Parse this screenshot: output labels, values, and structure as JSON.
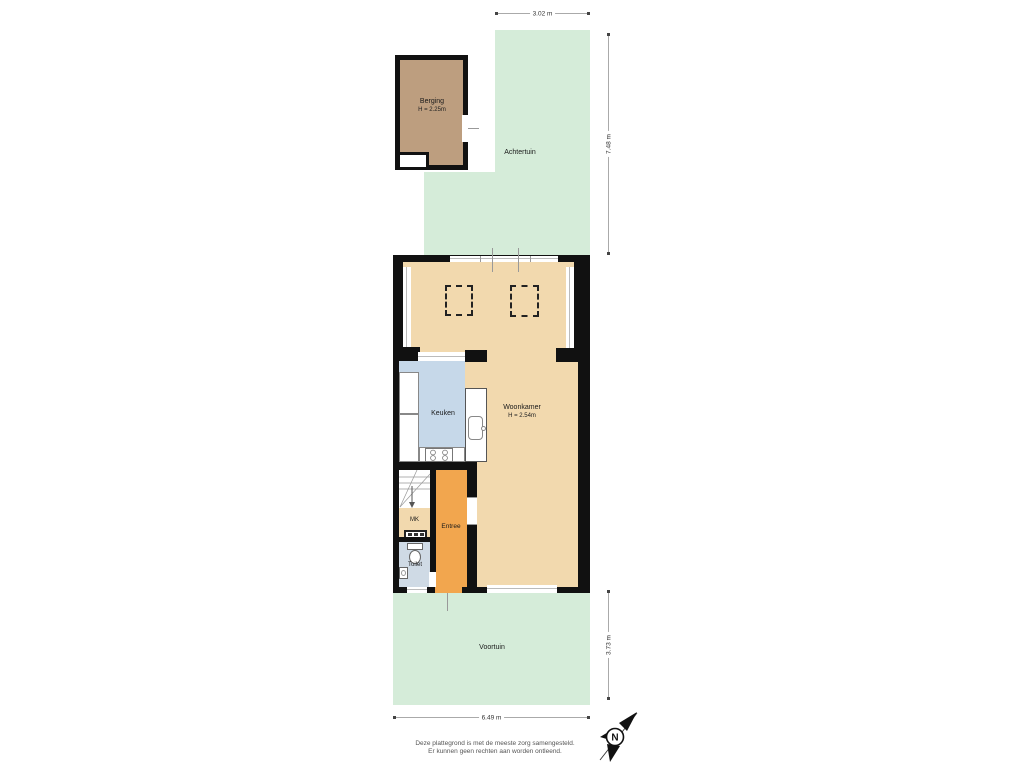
{
  "rooms": {
    "berging": {
      "label": "Berging",
      "height": "H = 2.25m"
    },
    "achtertuin": {
      "label": "Achtertuin"
    },
    "woonkamer": {
      "label": "Woonkamer",
      "height": "H = 2.54m"
    },
    "keuken": {
      "label": "Keuken"
    },
    "entree": {
      "label": "Entree"
    },
    "mk": {
      "label": "MK"
    },
    "toilet": {
      "label": "Toilet"
    },
    "voortuin": {
      "label": "Voortuin"
    }
  },
  "dimensions": {
    "top": "3.02 m",
    "right_upper": "7.48 m",
    "right_lower": "3.73 m",
    "bottom": "6.49 m"
  },
  "compass": {
    "north_label": "N"
  },
  "footer": {
    "line1": "Deze plattegrond is met de meeste zorg samengesteld.",
    "line2": "Er kunnen geen rechten aan worden ontleend."
  },
  "colors": {
    "garden": "#d5ecd9",
    "floor": "#f2d9ae",
    "kitchen": "#c6d8e9",
    "entree": "#f2a64e",
    "toilet": "#cfdae5",
    "shed": "#bd9e7f",
    "wall": "#111111"
  }
}
